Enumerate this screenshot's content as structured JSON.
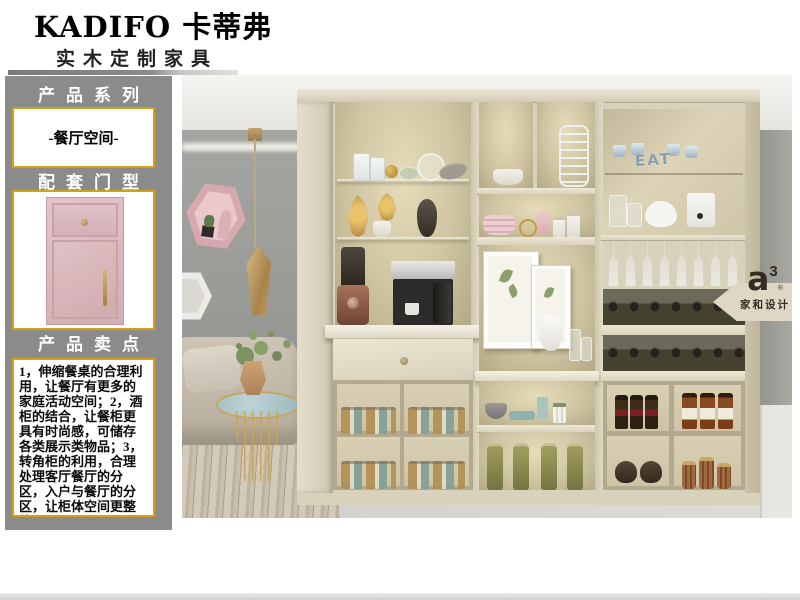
{
  "brand": {
    "logo_text": "KADIFO 卡蒂弗",
    "tagline": "实木定制家具"
  },
  "sidebar": {
    "series_header": "产品系列",
    "series_value": "-餐厅空间-",
    "door_header": "配套门型",
    "points_header": "产品卖点",
    "selling_points": [
      "1，伸缩餐桌的合理利用，让餐厅有更多的家庭活动空间；",
      "2，酒柜的结合，让餐柜更具有时尚感，可储存各类展示类物品；",
      "3，转角柜的利用，合理处理客厅餐厅的分区，入户与餐厅的分区，让柜体空间更整体；"
    ]
  },
  "photo": {
    "decor_text": "EAT",
    "watermark": {
      "letter": "a",
      "superscript": "3",
      "reg": "®",
      "studio": "家和设计"
    }
  },
  "colors": {
    "sidebar_gray": "#8b8b8b",
    "gold_border": "#d4a017",
    "door_pink": "#d8b6ba",
    "cabinet_cream": "#d8d1bc",
    "wall_gray": "#9c9c99",
    "watermark_brown": "#362b22"
  }
}
